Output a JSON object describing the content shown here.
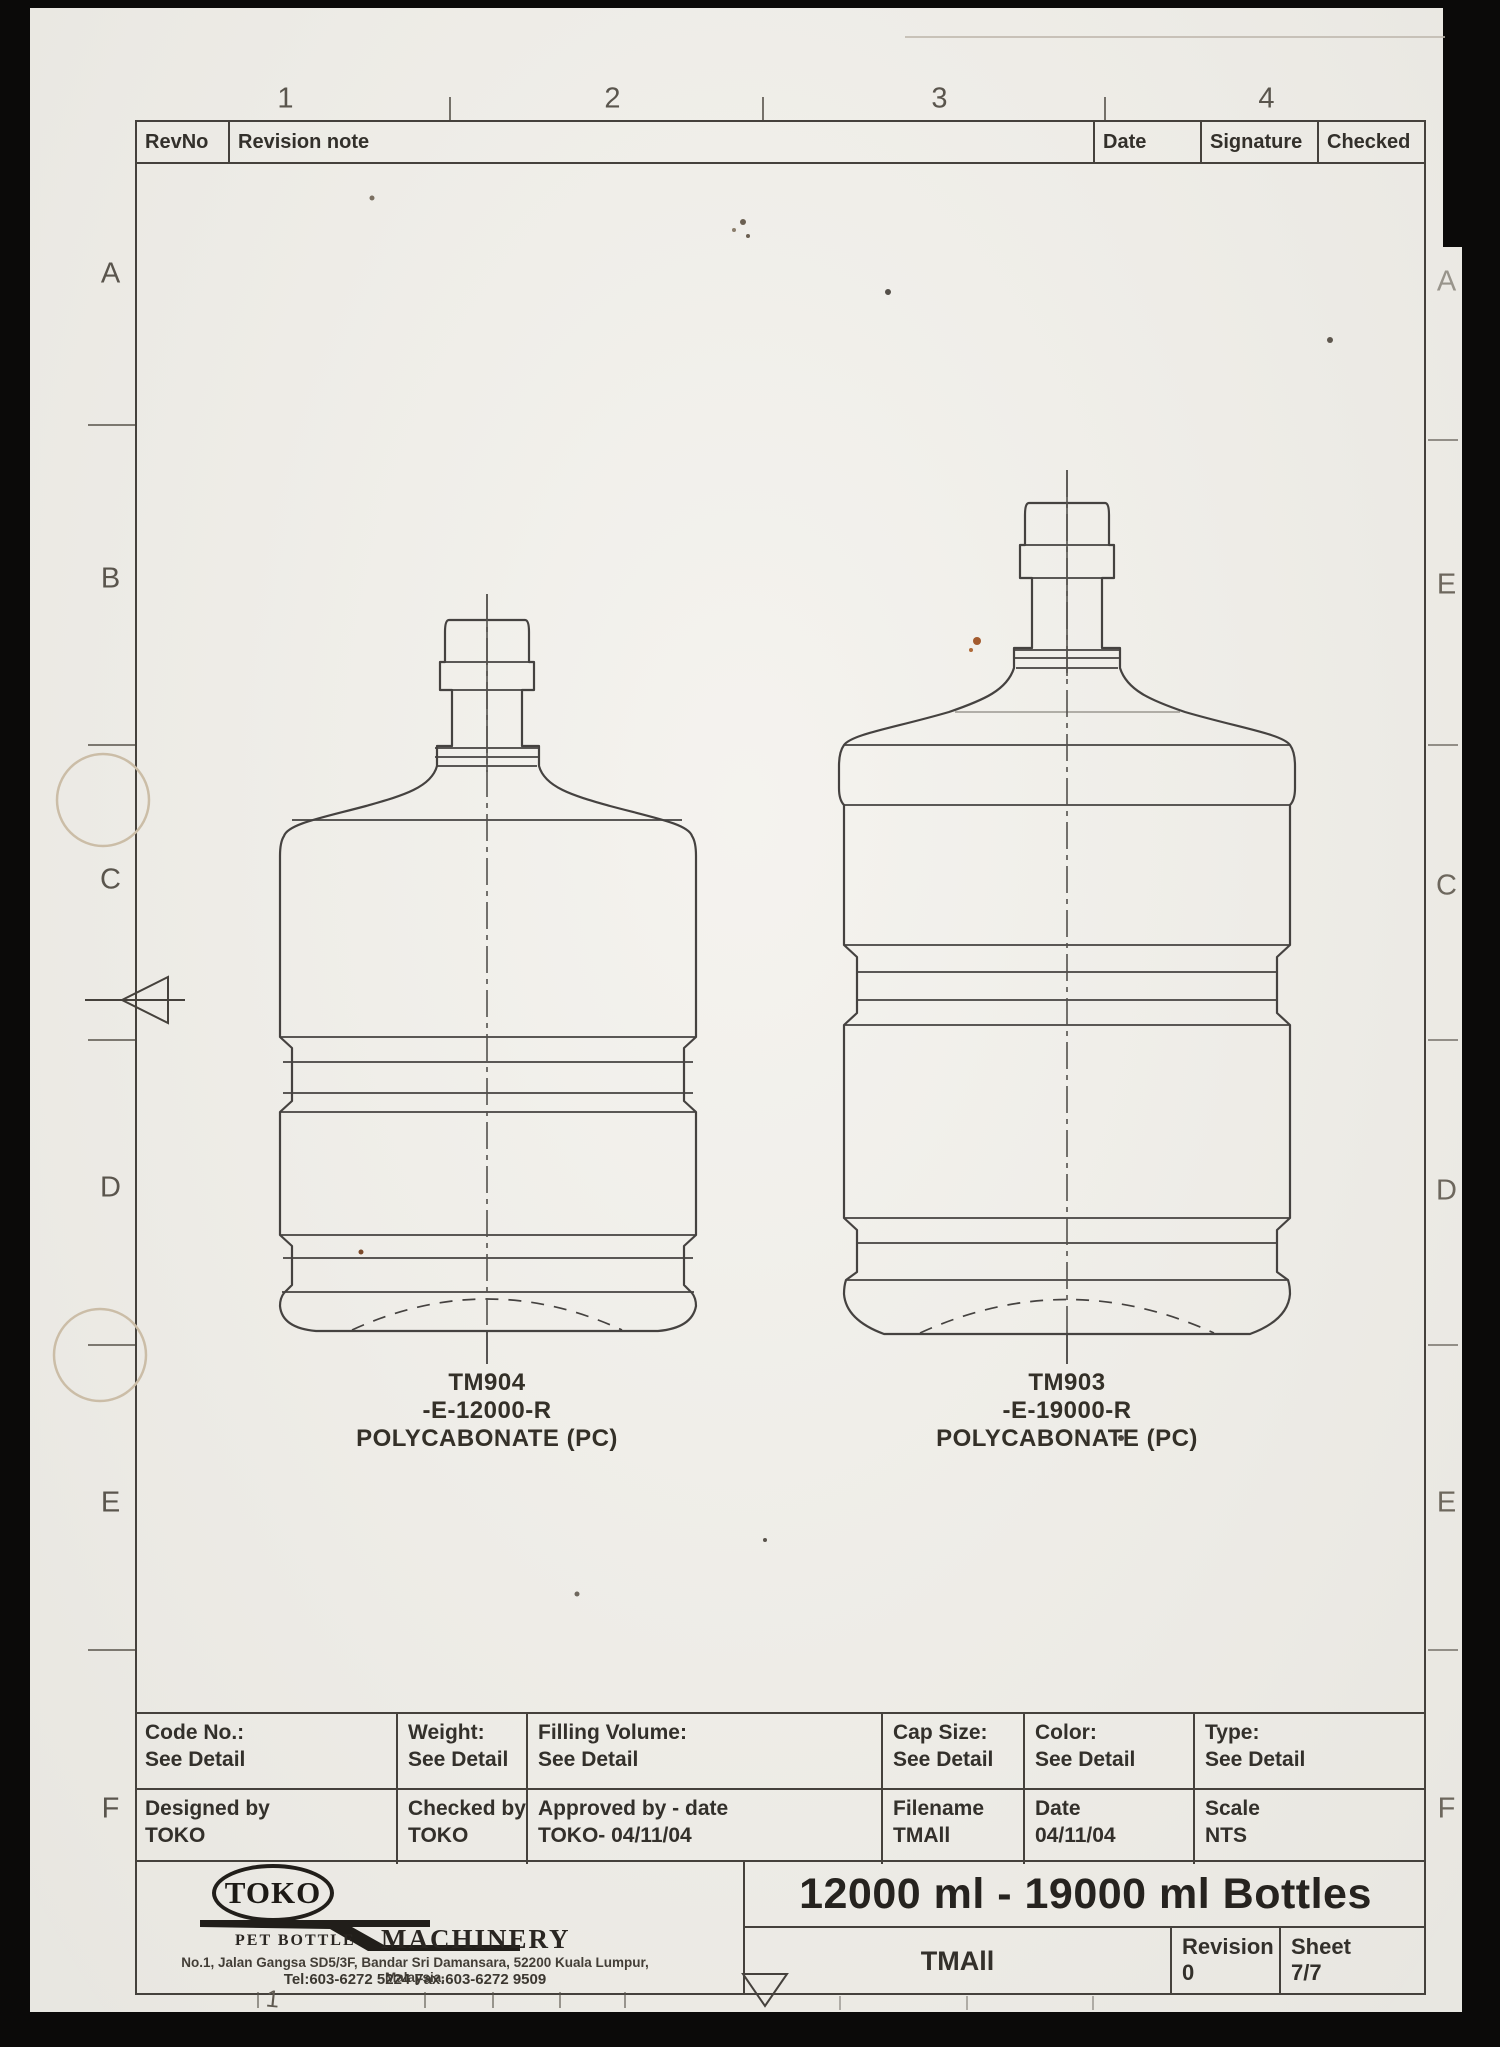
{
  "sheet": {
    "column_markers": [
      "1",
      "2",
      "3",
      "4"
    ],
    "row_markers_left": [
      "A",
      "B",
      "C",
      "D",
      "E",
      "F"
    ],
    "row_markers_right": [
      "A",
      "E",
      "C",
      "D",
      "E",
      "F"
    ],
    "bottom_margin_marker": "1"
  },
  "revision_header": {
    "rev_no": "RevNo",
    "note": "Revision note",
    "date": "Date",
    "signature": "Signature",
    "checked": "Checked"
  },
  "bottles": [
    {
      "model": "TM904",
      "variant": "-E-12000-R",
      "material": "POLYCABONATE (PC)"
    },
    {
      "model": "TM903",
      "variant": "-E-19000-R",
      "material": "POLYCABONATE (PC)"
    }
  ],
  "spec_table": {
    "code_no": {
      "label": "Code No.:",
      "value": "See Detail"
    },
    "weight": {
      "label": "Weight:",
      "value": "See Detail"
    },
    "filling_volume": {
      "label": "Filling Volume:",
      "value": "See Detail"
    },
    "cap_size": {
      "label": "Cap Size:",
      "value": "See Detail"
    },
    "color": {
      "label": "Color:",
      "value": "See Detail"
    },
    "type": {
      "label": "Type:",
      "value": "See Detail"
    },
    "designed_by": {
      "label": "Designed by",
      "value": "TOKO"
    },
    "checked_by": {
      "label": "Checked by",
      "value": "TOKO"
    },
    "approved_by": {
      "label": "Approved by - date",
      "value": "TOKO- 04/11/04"
    },
    "filename": {
      "label": "Filename",
      "value": "TMAll"
    },
    "date": {
      "label": "Date",
      "value": "04/11/04"
    },
    "scale": {
      "label": "Scale",
      "value": "NTS"
    }
  },
  "company": {
    "name": "TOKO",
    "tagline_left": "PET BOTTLE",
    "tagline_right": "MACHINERY",
    "address": "No.1, Jalan Gangsa SD5/3F, Bandar Sri Damansara, 52200 Kuala Lumpur, Malaysia.",
    "contact": "Tel:603-6272 5224   Fax:603-6272 9509"
  },
  "title_block": {
    "title": "12000 ml - 19000 ml Bottles",
    "drawing_name": "TMAll",
    "revision_label": "Revision",
    "revision_value": "0",
    "sheet_label": "Sheet",
    "sheet_value": "7/7"
  }
}
